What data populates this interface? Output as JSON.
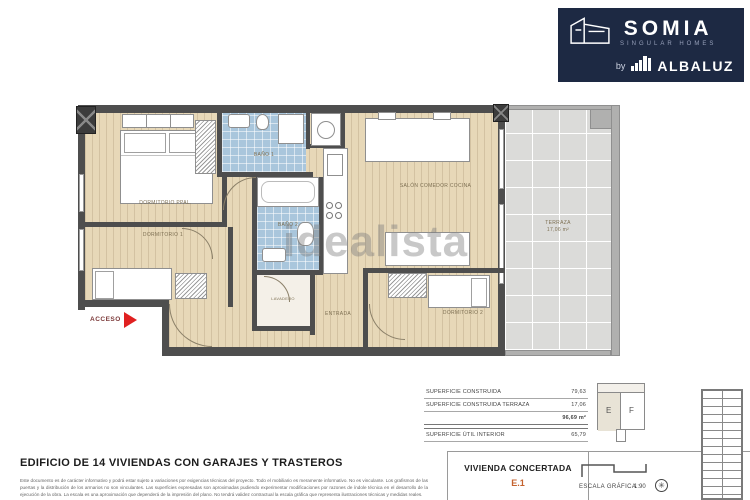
{
  "logo": {
    "brand": "SOMIA",
    "tagline": "SINGULAR HOMES",
    "by": "by",
    "partner": "ALBALUZ"
  },
  "watermark": "idealista",
  "plan": {
    "access_label": "ACCESO",
    "labels": {
      "dorm_ppal": "DORMITORIO PPAL.",
      "bano1": "BAÑO 1",
      "bano2": "BAÑO 2",
      "salon_line1": "SALÓN COMEDOR COCINA",
      "dorm1": "DORMITORIO 1",
      "dorm2": "DORMITORIO 2",
      "lavadero": "LAVADERO",
      "entrada": "ENTRADA",
      "terraza": "TERRAZA",
      "terraza_area": "17,06 m²"
    }
  },
  "areas_table": {
    "rows": [
      {
        "label": "SUPERFICIE CONSTRUIDA",
        "value": "79,63"
      },
      {
        "label": "SUPERFICIE CONSTRUIDA TERRAZA",
        "value": "17,06"
      }
    ],
    "total": "96,69 m²",
    "util_label": "SUPERFICIE ÚTIL INTERIOR",
    "util_value": "65,79"
  },
  "keyplan": {
    "left": "E",
    "right": "F"
  },
  "footer": {
    "title": "EDIFICIO DE 14 VIVIENDAS CON GARAJES Y TRASTEROS",
    "disclaimer": "Este documento es de carácter informativo y podrá estar sujeto a variaciones por exigencias técnicas del proyecto. Todo el mobiliario es meramente informativo. No es vinculante. Los grafismos de las puertas y la distribución de los armarios no son vinculantes. Las superficies expresadas son aproximadas pudiendo experimentar modificaciones por razones de índole técnica en el desarrollo de la ejecución de la obra. La escala es una aproximación que dependerá de la impresión del plano. No tendrá validez contractual la escala gráfica que representa ilustraciones técnicas y medidas reales.",
    "vivienda_title": "VIVIENDA CONCERTADA",
    "vivienda_code": "E.1",
    "scale_label": "ESCALA GRÁFICA",
    "scale_value": "1:90"
  }
}
